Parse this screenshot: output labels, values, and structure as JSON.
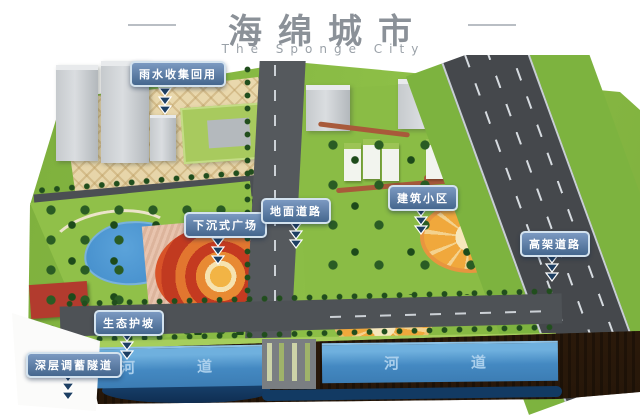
{
  "title": {
    "zh": "海绵城市",
    "en": "The Sponge City"
  },
  "callouts": [
    {
      "id": "rainwater-reuse",
      "text": "雨水收集回用"
    },
    {
      "id": "sunken-plaza",
      "text": "下沉式广场"
    },
    {
      "id": "ground-road",
      "text": "地面道路"
    },
    {
      "id": "building-community",
      "text": "建筑小区"
    },
    {
      "id": "elevated-road",
      "text": "高架道路"
    },
    {
      "id": "eco-slope",
      "text": "生态护坡"
    },
    {
      "id": "deep-storage-tunnel",
      "text": "深层调蓄隧道"
    }
  ],
  "rivers": [
    {
      "label": "河道"
    },
    {
      "label": "河道"
    }
  ],
  "colors": {
    "title_gray": "#8b9198",
    "callout_blue": "#45678e",
    "callout_border": "#d3e2ee",
    "grass_green": "#8dbf47",
    "river_blue": "#4489c2",
    "earth_brown": "#2e1c0c",
    "tunnel_navy": "#123a63",
    "plaza_tan": "#e6d6a9",
    "spiral_red": "#c43a20",
    "spiral_orange": "#e8953f"
  }
}
